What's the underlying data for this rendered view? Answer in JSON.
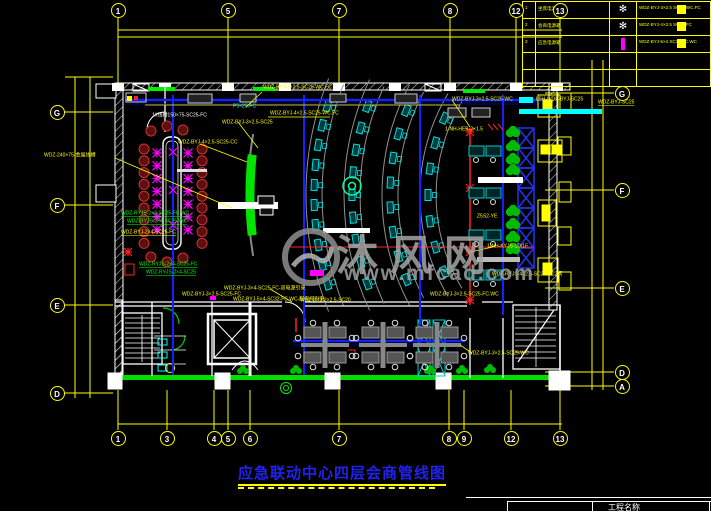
{
  "colors": {
    "background": "#000000",
    "grid_yellow": "#ffff00",
    "wall_white": "#ffffff",
    "cable_blue": "#1122ff",
    "bright_green": "#00ee00",
    "cyan": "#00ffff",
    "magenta": "#ff00ff",
    "red": "#ff2222",
    "seat_dark_red": "#5c0f0f",
    "watermark_gray": "#9a9a9a",
    "title_blue": "#2222ee"
  },
  "grid": {
    "top": [
      {
        "label": "1",
        "x": 118
      },
      {
        "label": "5",
        "x": 228
      },
      {
        "label": "7",
        "x": 339
      },
      {
        "label": "8",
        "x": 450
      },
      {
        "label": "12",
        "x": 516
      },
      {
        "label": "13",
        "x": 560
      }
    ],
    "bottom": [
      {
        "label": "1",
        "x": 118
      },
      {
        "label": "3",
        "x": 167
      },
      {
        "label": "4",
        "x": 214
      },
      {
        "label": "5",
        "x": 228
      },
      {
        "label": "6",
        "x": 250
      },
      {
        "label": "7",
        "x": 339
      },
      {
        "label": "8",
        "x": 449
      },
      {
        "label": "9",
        "x": 464
      },
      {
        "label": "12",
        "x": 511
      },
      {
        "label": "13",
        "x": 560
      }
    ],
    "left": [
      {
        "label": "G",
        "y": 112
      },
      {
        "label": "F",
        "y": 205
      },
      {
        "label": "E",
        "y": 305
      },
      {
        "label": "D",
        "y": 393
      }
    ],
    "right": [
      {
        "label": "G",
        "y": 93
      },
      {
        "label": "F",
        "y": 190
      },
      {
        "label": "E",
        "y": 288
      },
      {
        "label": "D",
        "y": 372
      },
      {
        "label": "A",
        "y": 386
      }
    ]
  },
  "legend": {
    "rows": [
      {
        "no": "1",
        "name": "坐席电源箱",
        "sym": "flower",
        "spec": "WDZ-BYJ-3×2.5",
        "note": "SC25-WC.FC"
      },
      {
        "no": "2",
        "name": "会商电源箱",
        "sym": "flower",
        "spec": "WDZ-BYJ-4×2.5",
        "note": "SC25-FC"
      },
      {
        "no": "3",
        "name": "应急电源箱",
        "sym": "bar",
        "spec": "WDZ-BYJ-5×4",
        "note": "SC32-FC.WC"
      },
      {
        "no": "",
        "name": "",
        "sym": "",
        "spec": "",
        "note": ""
      },
      {
        "no": "",
        "name": "",
        "sym": "",
        "spec": "",
        "note": ""
      }
    ]
  },
  "labels": [
    {
      "t": "WDZ-BYJ-3×2.5-SC25-WC.FC",
      "x": 263,
      "y": 85,
      "c": "y"
    },
    {
      "t": "WDZ-BYJ-4×2.5-SC25-WC.FC",
      "x": 270,
      "y": 111,
      "c": "y"
    },
    {
      "t": "1#线槽150×75-SC25-FC",
      "x": 152,
      "y": 113,
      "c": "w"
    },
    {
      "t": "P5×25-FC",
      "x": 233,
      "y": 104,
      "c": "c"
    },
    {
      "t": "WDZ-BYJ-3×2.5-SC25-WC",
      "x": 452,
      "y": 97,
      "c": "y"
    },
    {
      "t": "L5H-WDZ-BYJ-SC25",
      "x": 536,
      "y": 97,
      "c": "y"
    },
    {
      "t": "WDZ-240×75-金属线槽",
      "x": 44,
      "y": 153,
      "c": "y"
    },
    {
      "t": "WDZ-BYJ-4×2.5-SC25-CC",
      "x": 178,
      "y": 140,
      "c": "y"
    },
    {
      "t": "WDZ-BYJ-3×2.5-SC25",
      "x": 222,
      "y": 120,
      "c": "y"
    },
    {
      "t": "WDZ-RYJS-2×4-SC25-FC.WC",
      "x": 121,
      "y": 211,
      "c": "g",
      "u": 1
    },
    {
      "t": "WDZ-RYJS-2×4-SC25-WC",
      "x": 127,
      "y": 219,
      "c": "g",
      "u": 1
    },
    {
      "t": "WDZ-BYJ-2×4-SC25-FC",
      "x": 121,
      "y": 230,
      "c": "y",
      "u": 1
    },
    {
      "t": "WDZ-RYJS-2×4-SC25-FC",
      "x": 139,
      "y": 262,
      "c": "g",
      "u": 1
    },
    {
      "t": "WDZ-RYJS-2×4-SC25",
      "x": 146,
      "y": 270,
      "c": "g",
      "u": 1
    },
    {
      "t": "WDZ-BYJ-3×4-SC25-FC-双电源引来",
      "x": 224,
      "y": 286,
      "c": "y"
    },
    {
      "t": "WDZ-BYJ-5×4-SC32-FC.WC-配电间引来",
      "x": 233,
      "y": 297,
      "c": "y"
    },
    {
      "t": "WDZ-BYJ-3×2.5-SC25-FC",
      "x": 182,
      "y": 292,
      "c": "y"
    },
    {
      "t": "WDZ-RYJS-4×2.5-SC25-FC2间",
      "x": 492,
      "y": 272,
      "c": "y"
    },
    {
      "t": "WDZ-BYJ-3×2.5-SC25-FC.WC",
      "x": 430,
      "y": 292,
      "c": "y"
    },
    {
      "t": "1-NH-KYJS-1D/1F",
      "x": 487,
      "y": 244,
      "c": "y"
    },
    {
      "t": "Z5S2-YE",
      "x": 477,
      "y": 214,
      "c": "y"
    },
    {
      "t": "1-NH-HEB-2×1.5",
      "x": 445,
      "y": 127,
      "c": "y"
    },
    {
      "t": "WDZ-BYJ-3×2.5-SC25-WC",
      "x": 468,
      "y": 351,
      "c": "y"
    },
    {
      "t": "WDZ-BYJ-2×2.5-SC20",
      "x": 300,
      "y": 298,
      "c": "y"
    },
    {
      "t": "WDZ-BYJ-SC25",
      "x": 598,
      "y": 100,
      "c": "y",
      "u": 1
    }
  ],
  "watermark": {
    "name": "沐风网",
    "url": "www.mfcad.com"
  },
  "title": {
    "text": "应急联动中心四层会商管线图"
  },
  "footer": {
    "project_label": "工程名称"
  }
}
